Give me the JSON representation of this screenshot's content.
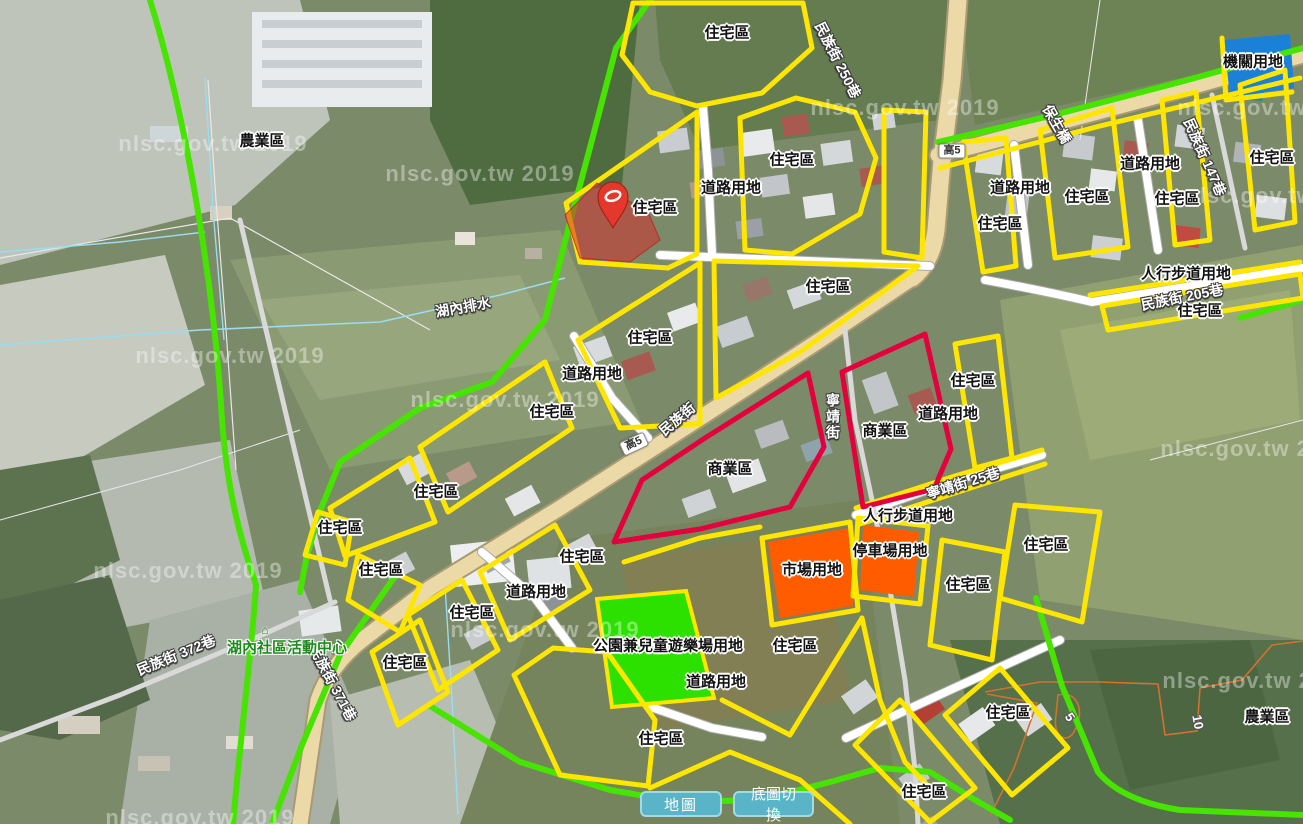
{
  "map": {
    "watermark_text": "nlsc.gov.tw 2019",
    "colors": {
      "residential_outline": "#ffe600",
      "boundary_green": "#46e400",
      "commercial_outline": "#e4003c",
      "market_fill": "#ff5c00",
      "park_fill": "#2ce000",
      "government_fill": "#1a80d8",
      "highlight_parcel_fill": "rgba(211,47,47,0.55)",
      "main_road_fill": "#ecd9a8",
      "button_bg": "#58b4c6"
    },
    "zone_labels": [
      {
        "text": "農業區",
        "x": 262,
        "y": 141
      },
      {
        "text": "住宅區",
        "x": 727,
        "y": 33
      },
      {
        "text": "住宅區",
        "x": 792,
        "y": 160
      },
      {
        "text": "道路用地",
        "x": 731,
        "y": 188
      },
      {
        "text": "住宅區",
        "x": 655,
        "y": 208
      },
      {
        "text": "機關用地",
        "x": 1253,
        "y": 62
      },
      {
        "text": "道路用地",
        "x": 1020,
        "y": 188
      },
      {
        "text": "住宅區",
        "x": 1087,
        "y": 197
      },
      {
        "text": "住宅區",
        "x": 1000,
        "y": 224
      },
      {
        "text": "道路用地",
        "x": 1150,
        "y": 164
      },
      {
        "text": "住宅區",
        "x": 1272,
        "y": 158
      },
      {
        "text": "住宅區",
        "x": 1177,
        "y": 199
      },
      {
        "text": "住宅區",
        "x": 828,
        "y": 287
      },
      {
        "text": "人行步道用地",
        "x": 1186,
        "y": 274
      },
      {
        "text": "住宅區",
        "x": 1200,
        "y": 311
      },
      {
        "text": "住宅區",
        "x": 650,
        "y": 338
      },
      {
        "text": "道路用地",
        "x": 592,
        "y": 374
      },
      {
        "text": "住宅區",
        "x": 552,
        "y": 412
      },
      {
        "text": "商業區",
        "x": 730,
        "y": 469
      },
      {
        "text": "商業區",
        "x": 885,
        "y": 431
      },
      {
        "text": "道路用地",
        "x": 948,
        "y": 414
      },
      {
        "text": "住宅區",
        "x": 973,
        "y": 381
      },
      {
        "text": "住宅區",
        "x": 436,
        "y": 492
      },
      {
        "text": "住宅區",
        "x": 340,
        "y": 528
      },
      {
        "text": "住宅區",
        "x": 381,
        "y": 570
      },
      {
        "text": "住宅區",
        "x": 582,
        "y": 557
      },
      {
        "text": "道路用地",
        "x": 536,
        "y": 592
      },
      {
        "text": "住宅區",
        "x": 472,
        "y": 613
      },
      {
        "text": "人行步道用地",
        "x": 908,
        "y": 516
      },
      {
        "text": "停車場用地",
        "x": 890,
        "y": 551
      },
      {
        "text": "市場用地",
        "x": 812,
        "y": 570
      },
      {
        "text": "住宅區",
        "x": 1046,
        "y": 545
      },
      {
        "text": "住宅區",
        "x": 968,
        "y": 585
      },
      {
        "text": "住宅區",
        "x": 795,
        "y": 646
      },
      {
        "text": "公園兼兒童遊樂場用地",
        "x": 668,
        "y": 646
      },
      {
        "text": "道路用地",
        "x": 716,
        "y": 682
      },
      {
        "text": "住宅區",
        "x": 661,
        "y": 739
      },
      {
        "text": "住宅區",
        "x": 405,
        "y": 663
      },
      {
        "text": "住宅區",
        "x": 924,
        "y": 792
      },
      {
        "text": "住宅區",
        "x": 1008,
        "y": 713
      },
      {
        "text": "農業區",
        "x": 1267,
        "y": 717
      }
    ],
    "street_labels": [
      {
        "text": "湖內排水",
        "x": 463,
        "y": 307,
        "rot": -10
      },
      {
        "text": "民族街 250巷",
        "x": 838,
        "y": 60,
        "rot": 63
      },
      {
        "text": "保生橋",
        "x": 1057,
        "y": 124,
        "rot": 60
      },
      {
        "text": "民族街 147巷",
        "x": 1205,
        "y": 157,
        "rot": 66
      },
      {
        "text": "民族街 205巷",
        "x": 1182,
        "y": 297,
        "rot": -11
      },
      {
        "text": "民族街",
        "x": 677,
        "y": 419,
        "rot": -40
      },
      {
        "text": "寧靖街",
        "x": 833,
        "y": 417,
        "rot": 0,
        "vertical": true
      },
      {
        "text": "寧靖街 25巷",
        "x": 963,
        "y": 483,
        "rot": -17
      },
      {
        "text": "民族街 372巷",
        "x": 176,
        "y": 655,
        "rot": -22
      },
      {
        "text": "民族街 371巷",
        "x": 333,
        "y": 683,
        "rot": 62
      }
    ],
    "poi_labels": [
      {
        "text": "湖內社區活動中心",
        "x": 287,
        "y": 648
      }
    ],
    "contour_labels": [
      {
        "text": "10",
        "x": 1198,
        "y": 722,
        "rot": 80
      },
      {
        "text": "5",
        "x": 1070,
        "y": 717,
        "rot": 55
      }
    ],
    "road_shields": [
      {
        "text": "高5",
        "x": 952,
        "y": 151,
        "rot": 0
      },
      {
        "text": "高5",
        "x": 634,
        "y": 444,
        "rot": -25
      }
    ],
    "watermarks": [
      {
        "x": 213,
        "y": 144
      },
      {
        "x": 905,
        "y": 108
      },
      {
        "x": 1272,
        "y": 108
      },
      {
        "x": 480,
        "y": 174
      },
      {
        "x": 1280,
        "y": 196
      },
      {
        "x": 230,
        "y": 356
      },
      {
        "x": 505,
        "y": 400
      },
      {
        "x": 1255,
        "y": 449
      },
      {
        "x": 188,
        "y": 571
      },
      {
        "x": 545,
        "y": 630
      },
      {
        "x": 1257,
        "y": 681
      },
      {
        "x": 200,
        "y": 818
      }
    ],
    "buttons": [
      {
        "label": "地圖"
      },
      {
        "label": "底圖切換"
      }
    ]
  }
}
